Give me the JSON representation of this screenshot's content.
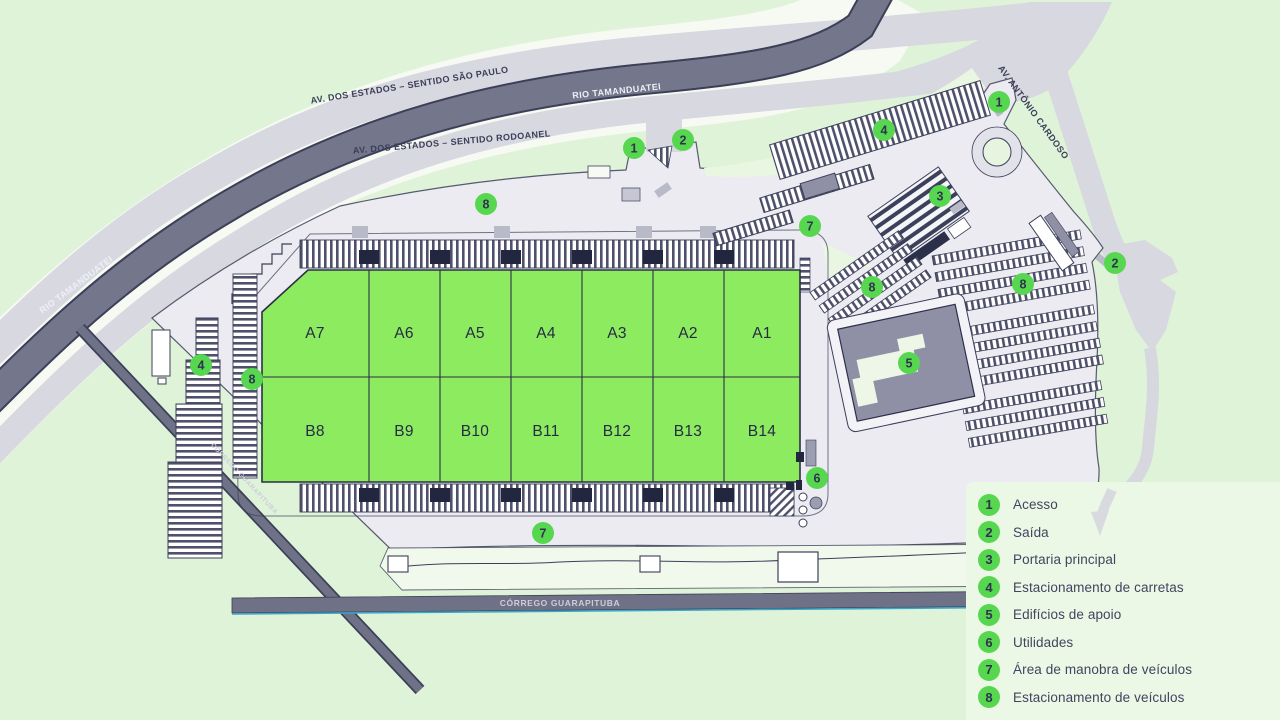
{
  "map": {
    "roads": {
      "av_estados_sp": "AV. DOS ESTADOS – SENTIDO SÃO PAULO",
      "av_estados_rodoanel": "AV. DOS ESTADOS – SENTIDO RODOANEL",
      "av_antonio_cardoso": "AV. ANTÔNIO CARDOSO"
    },
    "waterways": {
      "rio_tamanduatei": "RIO TAMANDUATEI",
      "corrego_guarapituba": "CÓRREGO GUARAPITUBA"
    },
    "warehouse": {
      "row_a": [
        "A7",
        "A6",
        "A5",
        "A4",
        "A3",
        "A2",
        "A1"
      ],
      "row_b": [
        "B8",
        "B9",
        "B10",
        "B11",
        "B12",
        "B13",
        "B14"
      ]
    },
    "markers": [
      {
        "number": "1",
        "x": 634,
        "y": 148
      },
      {
        "number": "2",
        "x": 683,
        "y": 140
      },
      {
        "number": "8",
        "x": 486,
        "y": 204
      },
      {
        "number": "4",
        "x": 884,
        "y": 130
      },
      {
        "number": "1",
        "x": 999,
        "y": 102
      },
      {
        "number": "3",
        "x": 940,
        "y": 196
      },
      {
        "number": "7",
        "x": 810,
        "y": 226
      },
      {
        "number": "2",
        "x": 1115,
        "y": 263
      },
      {
        "number": "8",
        "x": 872,
        "y": 287
      },
      {
        "number": "8",
        "x": 1023,
        "y": 284
      },
      {
        "number": "4",
        "x": 201,
        "y": 365
      },
      {
        "number": "8",
        "x": 252,
        "y": 379
      },
      {
        "number": "5",
        "x": 909,
        "y": 363
      },
      {
        "number": "6",
        "x": 817,
        "y": 478
      },
      {
        "number": "7",
        "x": 543,
        "y": 533
      }
    ]
  },
  "legend": {
    "items": [
      {
        "number": "1",
        "label": "Acesso"
      },
      {
        "number": "2",
        "label": "Saída"
      },
      {
        "number": "3",
        "label": "Portaria principal"
      },
      {
        "number": "4",
        "label": "Estacionamento de carretas"
      },
      {
        "number": "5",
        "label": "Edifícios de apoio"
      },
      {
        "number": "6",
        "label": "Utilidades"
      },
      {
        "number": "7",
        "label": "Área de manobra de veículos"
      },
      {
        "number": "8",
        "label": "Estacionamento de veículos"
      }
    ]
  },
  "colors": {
    "background": "#dff3d9",
    "legend_panel": "#ecf8e6",
    "road": "#d8d8e0",
    "river": "#74768b",
    "warehouse_green": "#8ceb5e",
    "marker_green": "#57d74f",
    "ink": "#3b3e58"
  }
}
